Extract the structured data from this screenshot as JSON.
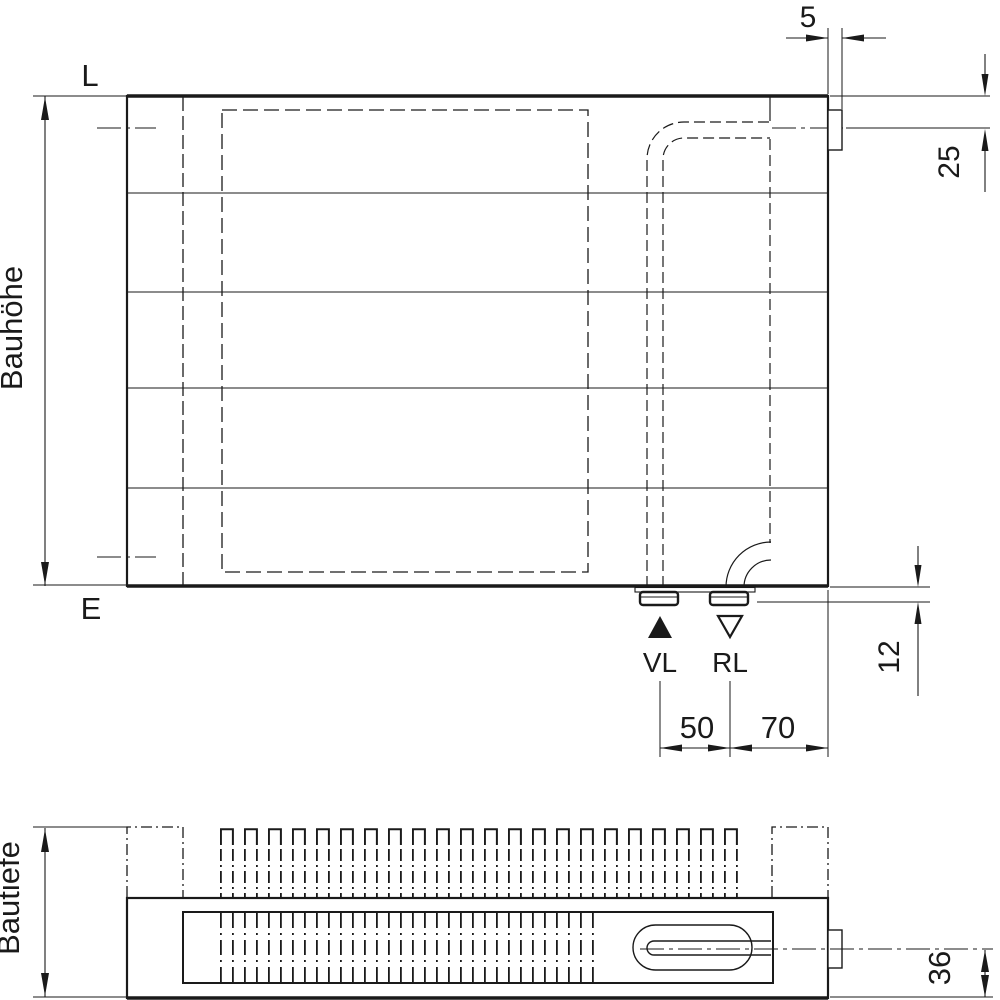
{
  "colors": {
    "background": "#ffffff",
    "line": "#1a1a1a"
  },
  "front_view": {
    "height_label": "Bauhöhe",
    "wall_levels": {
      "top": "L",
      "bottom": "E"
    },
    "connections": {
      "supply": "VL",
      "return": "RL"
    },
    "dims": {
      "side_tab_width": "5",
      "top_hook_offset": "25",
      "connection_drop": "12",
      "supply_return_spacing": "50",
      "return_to_edge": "70"
    }
  },
  "plan_view": {
    "depth_label": "Bautiefe",
    "dims": {
      "pipe_center_to_front": "36"
    }
  }
}
